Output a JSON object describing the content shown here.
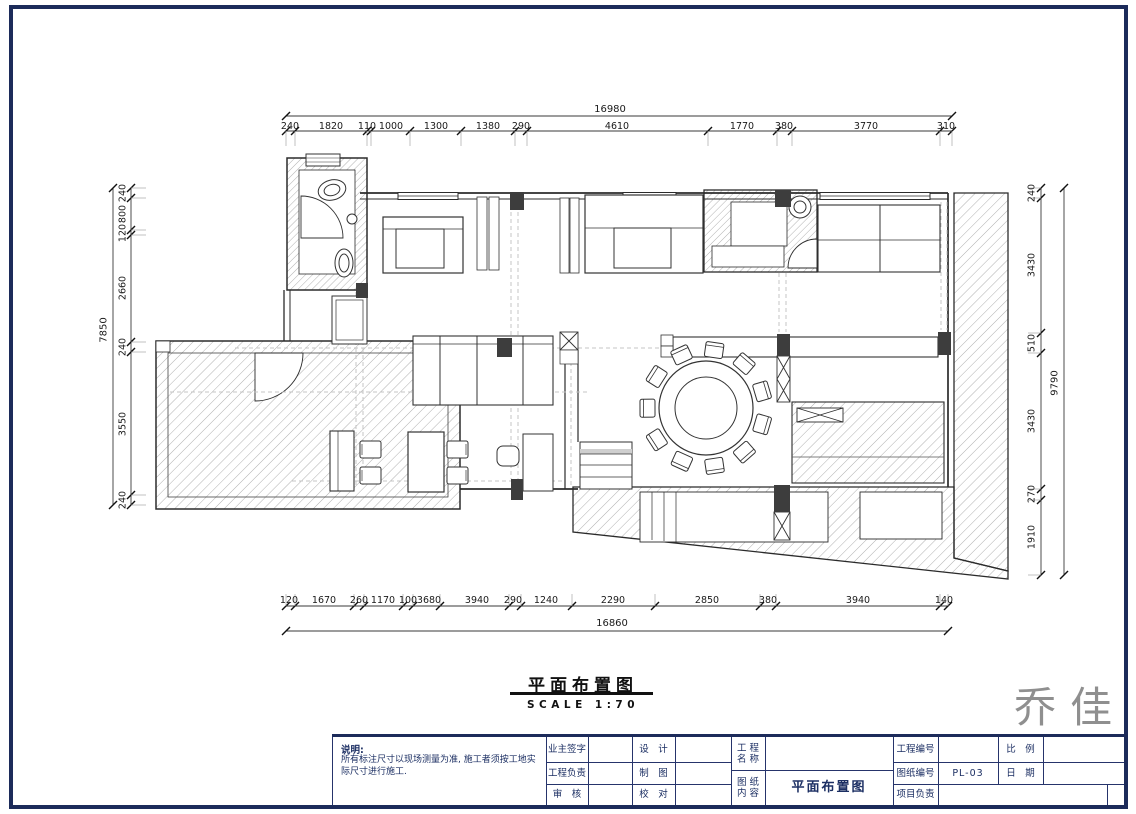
{
  "drawing": {
    "title": "平面布置图",
    "scale": "SCALE 1:70"
  },
  "logo": {
    "text": "乔佳"
  },
  "dimensions": {
    "top": {
      "total": "16980",
      "segments": [
        "240",
        "1820",
        "110",
        "1000",
        "1300",
        "1380",
        "290",
        "4610",
        "1770",
        "380",
        "3770",
        "310"
      ]
    },
    "bottom": {
      "total": "16860",
      "segments": [
        "120",
        "1670",
        "260",
        "1170",
        "100",
        "3680",
        "3940",
        "290",
        "1240",
        "2290",
        "2850",
        "380",
        "3940",
        "140"
      ]
    },
    "left": {
      "total": "7850",
      "segments": [
        "240",
        "800",
        "120",
        "2660",
        "240",
        "3550",
        "240"
      ]
    },
    "right": {
      "total": "9790",
      "segments": [
        "240",
        "3430",
        "510",
        "3430",
        "270",
        "1910"
      ]
    }
  },
  "title_block": {
    "note_label": "说明:",
    "note_text": "所有标注尺寸以现场测量为准, 施工者须按工地实际尺寸进行施工.",
    "sign_labels": [
      "业主签字",
      "工程负责",
      "审　核"
    ],
    "design_labels": [
      "设　计",
      "制　图",
      "校　对"
    ],
    "project_name_label": "工 程\n名 称",
    "content_label": "图 纸\n内 容",
    "content_value": "平面布置图",
    "right_labels": [
      "工程编号",
      "图纸编号",
      "项目负责"
    ],
    "drawing_no": "PL-03",
    "scale_label": "比　例",
    "date_label": "日　期"
  },
  "colors": {
    "border": "#1c2b5a",
    "table_line": "#26346b",
    "label_text": "#1c2f63",
    "logo_gray": "#8f8f8f"
  }
}
